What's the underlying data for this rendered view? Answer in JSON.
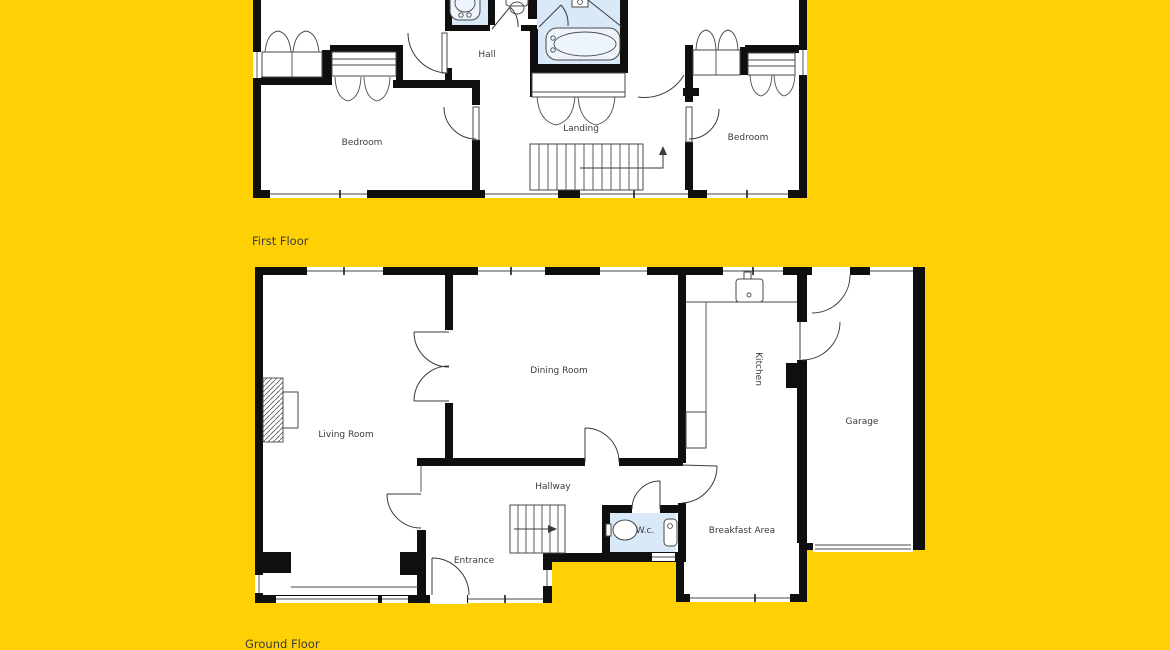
{
  "palette": {
    "background": "#ffd105",
    "wall": "#0f0f0f",
    "room": "#ffffff",
    "wet_room": "#d9e9f7",
    "fixture": "#edf4fb",
    "line": "#3a3a3a",
    "label": "#3b3b3b"
  },
  "first_floor": {
    "title": "First Floor",
    "rooms": {
      "hall": "Hall",
      "landing": "Landing",
      "bedroom_left": "Bedroom",
      "bedroom_right": "Bedroom"
    }
  },
  "ground_floor": {
    "title": "Ground Floor",
    "rooms": {
      "living_room": "Living Room",
      "dining_room": "Dining Room",
      "kitchen": "Kitchen",
      "garage": "Garage",
      "hallway": "Hallway",
      "wc": "W.c.",
      "breakfast_area": "Breakfast Area",
      "entrance": "Entrance"
    }
  }
}
